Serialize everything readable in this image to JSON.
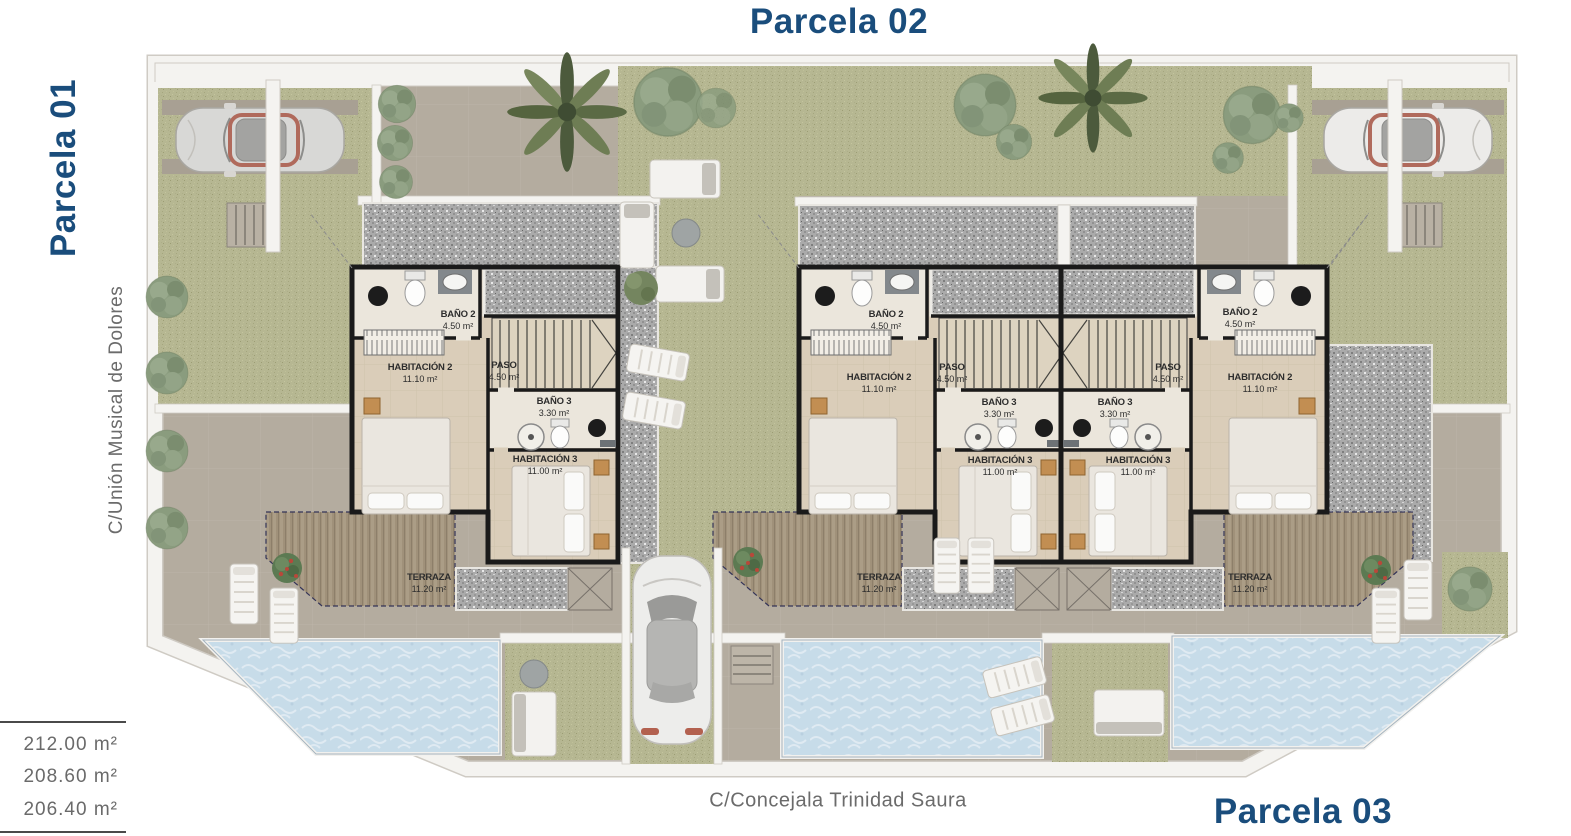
{
  "titles": {
    "top": "Parcela 02",
    "left": "Parcela 01",
    "bottom_right": "Parcela 03"
  },
  "streets": {
    "left": "C/Unión Musical de Dolores",
    "bottom": "C/Concejala Trinidad Saura"
  },
  "area_table": {
    "values": [
      "212.00 m²",
      "208.60 m²",
      "206.40 m²"
    ]
  },
  "villas": [
    {
      "rooms": [
        {
          "label": "BAÑO 2",
          "area": "4.50 m²"
        },
        {
          "label": "HABITACIÓN 2",
          "area": "11.10 m²"
        },
        {
          "label": "PASO",
          "area": "4.50 m²"
        },
        {
          "label": "BAÑO 3",
          "area": "3.30 m²"
        },
        {
          "label": "HABITACIÓN 3",
          "area": "11.00 m²"
        },
        {
          "label": "TERRAZA",
          "area": "11.20 m²"
        }
      ]
    },
    {
      "rooms": [
        {
          "label": "BAÑO 2",
          "area": "4.50 m²"
        },
        {
          "label": "HABITACIÓN 2",
          "area": "11.10 m²"
        },
        {
          "label": "PASO",
          "area": "4.50 m²"
        },
        {
          "label": "BAÑO 3",
          "area": "3.30 m²"
        },
        {
          "label": "HABITACIÓN 3",
          "area": "11.00 m²"
        },
        {
          "label": "TERRAZA",
          "area": "11.20 m²"
        }
      ]
    },
    {
      "rooms": [
        {
          "label": "BAÑO 2",
          "area": "4.50 m²"
        },
        {
          "label": "HABITACIÓN 2",
          "area": "11.10 m²"
        },
        {
          "label": "PASO",
          "area": "4.50 m²"
        },
        {
          "label": "BAÑO 3",
          "area": "3.30 m²"
        },
        {
          "label": "HABITACIÓN 3",
          "area": "11.00 m²"
        },
        {
          "label": "TERRAZA",
          "area": "11.20 m²"
        }
      ]
    }
  ],
  "colors": {
    "accent_blue": "#1a4d7c",
    "street_text": "#6b6b6b",
    "street": "#b4ac9f",
    "grass": "#b6b792",
    "gravel": "#aaaaaa",
    "water": "#c7dce9",
    "floor": "#dacdb9",
    "wall": "#1a1a1a",
    "terrace": "#a0917a"
  }
}
